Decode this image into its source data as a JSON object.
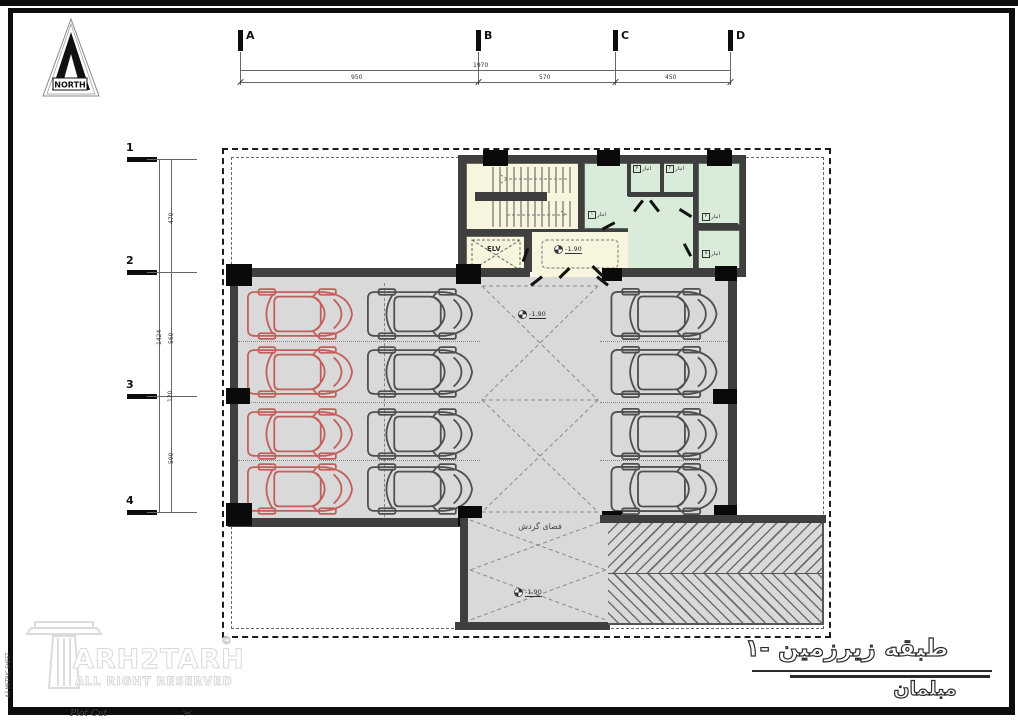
{
  "sheet": {
    "north_label": "NORTH",
    "plot_cut_label": "Plot Cut",
    "scissors_icon": "✂",
    "side_note": "A3 METRIC SHEET"
  },
  "grid": {
    "top": {
      "markers": [
        "A",
        "B",
        "C",
        "D"
      ],
      "total": "1970",
      "segments": [
        "950",
        "570",
        "450"
      ]
    },
    "left": {
      "markers": [
        "1",
        "2",
        "3",
        "4"
      ],
      "total": "1424",
      "segments": [
        "470",
        "560",
        "590"
      ],
      "minor": "120"
    }
  },
  "core": {
    "elevator_label": "ELV",
    "storage_rooms": [
      {
        "label": "انبار",
        "num": "۱"
      },
      {
        "label": "انبار",
        "num": "۲"
      },
      {
        "label": "انبار",
        "num": "۳"
      },
      {
        "label": "انبار",
        "num": "۴"
      },
      {
        "label": "انبار",
        "num": "۵"
      }
    ]
  },
  "plan": {
    "levels": [
      "-1.90",
      "-1.90",
      "-1.90"
    ],
    "circulation_label": "فضای گردش"
  },
  "parking": {
    "left_block_rows": 4,
    "left_block_cols": 2,
    "right_block_rows": 4,
    "red_cars": 4,
    "gray_cars": 8
  },
  "title_block": {
    "title": "طبقه زیرزمین -۱",
    "subtitle": "مبلمان"
  },
  "watermark": {
    "brand": "ARH2TARH",
    "tagline": "ALL RIGHT RESERVED",
    "copyright": "©"
  },
  "colors": {
    "floor": "#d9d9d9",
    "wall": "#3f3f3f",
    "column": "#0a0a0a",
    "stair_room": "#f7f5dd",
    "storage_room": "#d9ecd9",
    "car_red": "#c1605a",
    "car_gray": "#4f4f4f"
  }
}
